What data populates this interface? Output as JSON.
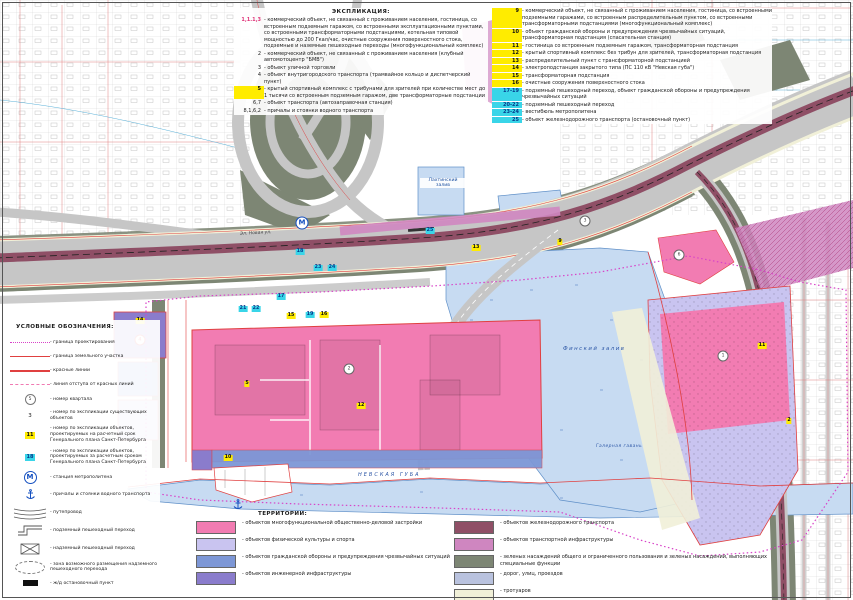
{
  "colors": {
    "water": "#c7dbf2",
    "road": "#c6c6c6",
    "rail": "#8f4f66",
    "pink": "#f27cb2",
    "lavender": "#c9c4f0",
    "blue": "#7d97d6",
    "purple": "#8a7ccc",
    "pinkviolet": "#cf86c0",
    "green": "#7d8674",
    "sidewalk": "#f1f0d8",
    "redline": "#e04040",
    "bound": "#d843c8",
    "badgey": "#ffec00",
    "badgec": "#39d5e8",
    "metro": "#1550c0",
    "waterlabel": "#2b55a5"
  },
  "explication": {
    "title": "ЭКСПЛИКАЦИЯ:",
    "col1": [
      {
        "num": "1,1.1,3",
        "mark": "red",
        "text": "- коммерческий объект, не связанный с проживанием населения, гостиница, со встроенным подземным гаражом, со встроенными эксплуатационными пунктами, со встроенными трансформаторными подстанциями, котельная типовой мощностью до 200 Гкал/час, очистные сооружения поверхностного стока, подземные и наземные пешеходные переходы (многофункциональный комплекс)"
      },
      {
        "num": "2",
        "mark": "none",
        "text": "- коммерческий объект, не связанный с проживанием населения (клубный автомотоцентр \"БМВ\")"
      },
      {
        "num": "3",
        "mark": "none",
        "text": "- объект уличной торговли"
      },
      {
        "num": "4",
        "mark": "none",
        "text": "- объект внутригородского транспорта (трамвайное кольцо и диспетчерский пункт)"
      },
      {
        "num": "5",
        "mark": "yellow",
        "text": "- крытый спортивный комплекс с трибунами для зрителей при количестве мест до 1 тысячи со встроенным подземным гаражом, две трансформаторные подстанции"
      },
      {
        "num": "6,7",
        "mark": "none",
        "text": "- объект транспорта (автозаправочная станция)"
      },
      {
        "num": "8,1,6,2",
        "mark": "none",
        "text": "- причалы и стоянки водного транспорта"
      }
    ],
    "col2": [
      {
        "num": "9",
        "mark": "yellow",
        "text": "- коммерческий объект, не связанный с проживанием населения, гостиница, со встроенными подземными гаражами, со встроенным распределительным пунктом, со встроенными трансформаторными подстанциями (многофункциональный комплекс)"
      },
      {
        "num": "10",
        "mark": "yellow",
        "text": "- объект гражданской обороны и предупреждения чрезвычайных ситуаций, трансформаторная подстанция (спасательная станция)"
      },
      {
        "num": "11",
        "mark": "yellow",
        "text": "- гостиница со встроенным подземным гаражом, трансформаторная подстанция"
      },
      {
        "num": "12",
        "mark": "yellow",
        "text": "- крытый спортивный комплекс без трибун для зрителей, трансформаторная подстанция"
      },
      {
        "num": "13",
        "mark": "yellow",
        "text": "- распределительный пункт с трансформаторной подстанцией"
      },
      {
        "num": "14",
        "mark": "yellow",
        "text": "- электроподстанция закрытого типа (ПС 110 кВ \"Невская губа\")"
      },
      {
        "num": "15",
        "mark": "yellow",
        "text": "- трансформаторная подстанция"
      },
      {
        "num": "16",
        "mark": "yellow",
        "text": "- очистные сооружения поверхностного стока"
      },
      {
        "num": "17-19",
        "mark": "cyan",
        "text": "- подземный пешеходный переход, объект гражданской обороны и предупреждения чрезвычайных ситуаций"
      },
      {
        "num": "20-22",
        "mark": "cyan",
        "text": "- подземный пешеходный переход"
      },
      {
        "num": "23-24",
        "mark": "cyan",
        "text": "- вестибюль метрополитена"
      },
      {
        "num": "25",
        "mark": "cyan",
        "text": "- объект железнодорожного транспорта (остановочный пункт)"
      }
    ]
  },
  "symbols_legend": {
    "title": "УСЛОВНЫЕ ОБОЗНАЧЕНИЯ:",
    "items": [
      {
        "symbol": "boundary-dotted-line",
        "sample": "",
        "label": "- граница проектирования"
      },
      {
        "symbol": "red-line",
        "sample": "",
        "label": "- граница земельного участка"
      },
      {
        "symbol": "red-thick-line",
        "sample": "",
        "label": "- красные линии"
      },
      {
        "symbol": "pink-dashed-line",
        "sample": "",
        "label": "- линия отступа от красных линий"
      },
      {
        "symbol": "circle-number",
        "sample": "5",
        "label": "- номер квартала"
      },
      {
        "symbol": "plain-number",
        "sample": "3",
        "label": "- номер по экспликации существующих объектов"
      },
      {
        "symbol": "yellow-number",
        "sample": "11",
        "label": "- номер по экспликации объектов, проектируемых на расчетный срок Генерального плана Санкт-Петербурга"
      },
      {
        "symbol": "cyan-number",
        "sample": "18",
        "label": "- номер по экспликации объектов, проектируемых за расчетным сроком Генерального плана Санкт-Петербурга"
      },
      {
        "symbol": "metro",
        "sample": "М",
        "label": "- станция метрополитена"
      },
      {
        "symbol": "anchor",
        "sample": "",
        "label": "- причалы и стоянки водного транспорта"
      },
      {
        "symbol": "overpass-arcs",
        "sample": "",
        "label": "- путепровод"
      },
      {
        "symbol": "underpass",
        "sample": "",
        "label": "- подземный пешеходный переход"
      },
      {
        "symbol": "overpass-box",
        "sample": "",
        "label": "- надземный пешеходный переход"
      },
      {
        "symbol": "zone-ellipse",
        "sample": "",
        "label": "- зона возможного размещения надземного пешеходного перехода"
      },
      {
        "symbol": "black-rect",
        "sample": "",
        "label": "- ж/д остановочный пункт"
      }
    ]
  },
  "territories": {
    "title": "ТЕРРИТОРИИ:",
    "col1": [
      {
        "color": "#f27cb2",
        "label": "- объектов многофункциональной общественно-деловой застройки"
      },
      {
        "color": "#c9c4f0",
        "label": "- объектов физической культуры и спорта"
      },
      {
        "color": "#7d97d6",
        "label": "- объектов гражданской обороны и предупреждения чрезвычайных ситуаций"
      },
      {
        "color": "#8a7ccc",
        "label": "- объектов инженерной инфраструктуры"
      }
    ],
    "col2": [
      {
        "color": "#8f4f66",
        "label": "- объектов железнодорожного транспорта"
      },
      {
        "color": "#cf86c0",
        "label": "- объектов транспортной инфраструктуры"
      },
      {
        "color": "#7d8674",
        "label": "- зеленых насаждений общего и ограниченного пользования и зеленых насаждений, выполняющих специальные функции"
      },
      {
        "color": "#b9c2de",
        "label": "- дорог, улиц, проездов"
      },
      {
        "color": "#f1f0d8",
        "label": "- тротуаров"
      }
    ]
  },
  "map": {
    "markers": [
      {
        "label": "14",
        "x": 140,
        "y": 321,
        "kind": "yellow"
      },
      {
        "label": "4",
        "x": 140,
        "y": 340,
        "kind": "red-circle"
      },
      {
        "label": "5",
        "x": 247,
        "y": 384,
        "kind": "yellow"
      },
      {
        "label": "2",
        "x": 349,
        "y": 369,
        "kind": "circle"
      },
      {
        "label": "12",
        "x": 361,
        "y": 406,
        "kind": "yellow"
      },
      {
        "label": "10",
        "x": 228,
        "y": 458,
        "kind": "yellow"
      },
      {
        "label": "15",
        "x": 291,
        "y": 316,
        "kind": "yellow"
      },
      {
        "label": "19",
        "x": 310,
        "y": 315,
        "kind": "cyan"
      },
      {
        "label": "16",
        "x": 324,
        "y": 315,
        "kind": "yellow"
      },
      {
        "label": "17",
        "x": 281,
        "y": 297,
        "kind": "cyan"
      },
      {
        "label": "18",
        "x": 300,
        "y": 252,
        "kind": "cyan"
      },
      {
        "label": "23",
        "x": 318,
        "y": 268,
        "kind": "cyan"
      },
      {
        "label": "24",
        "x": 332,
        "y": 268,
        "kind": "cyan"
      },
      {
        "label": "21",
        "x": 243,
        "y": 309,
        "kind": "cyan"
      },
      {
        "label": "22",
        "x": 256,
        "y": 309,
        "kind": "cyan"
      },
      {
        "label": "25",
        "x": 430,
        "y": 231,
        "kind": "cyan"
      },
      {
        "label": "13",
        "x": 476,
        "y": 248,
        "kind": "yellow"
      },
      {
        "label": "9",
        "x": 560,
        "y": 242,
        "kind": "yellow"
      },
      {
        "label": "3",
        "x": 585,
        "y": 221,
        "kind": "circle"
      },
      {
        "label": "6",
        "x": 679,
        "y": 255,
        "kind": "circle"
      },
      {
        "label": "1",
        "x": 723,
        "y": 356,
        "kind": "circle"
      },
      {
        "label": "11",
        "x": 762,
        "y": 346,
        "kind": "yellow"
      },
      {
        "label": "2",
        "x": 789,
        "y": 421,
        "kind": "yellow"
      },
      {
        "label": "М",
        "x": 302,
        "y": 223,
        "kind": "metro"
      },
      {
        "label": "",
        "x": 238,
        "y": 506,
        "kind": "anchor"
      }
    ],
    "labels": [
      {
        "text": "Эл. Новая ул.",
        "x": 240,
        "y": 231,
        "size": 4.5,
        "color": "#444",
        "rot": -3,
        "spacing": 0,
        "boxed": false
      },
      {
        "text": "Лахтинский залив",
        "x": 420,
        "y": 178,
        "size": 4.6,
        "color": "#1a4fa0",
        "rot": 0,
        "spacing": 0,
        "boxed": true,
        "w": 44
      },
      {
        "text": "Финский залив",
        "x": 563,
        "y": 346,
        "size": 5.4,
        "color": "#2b55a5",
        "rot": 0,
        "spacing": 1.5,
        "boxed": false
      },
      {
        "text": "НЕВСКАЯ ГУБА",
        "x": 358,
        "y": 472,
        "size": 5,
        "color": "#2b55a5",
        "rot": 0,
        "spacing": 2,
        "boxed": false
      },
      {
        "text": "Галерная гавань",
        "x": 596,
        "y": 444,
        "size": 4.4,
        "color": "#2b55a5",
        "rot": 0,
        "spacing": 0.5,
        "boxed": false
      }
    ]
  }
}
